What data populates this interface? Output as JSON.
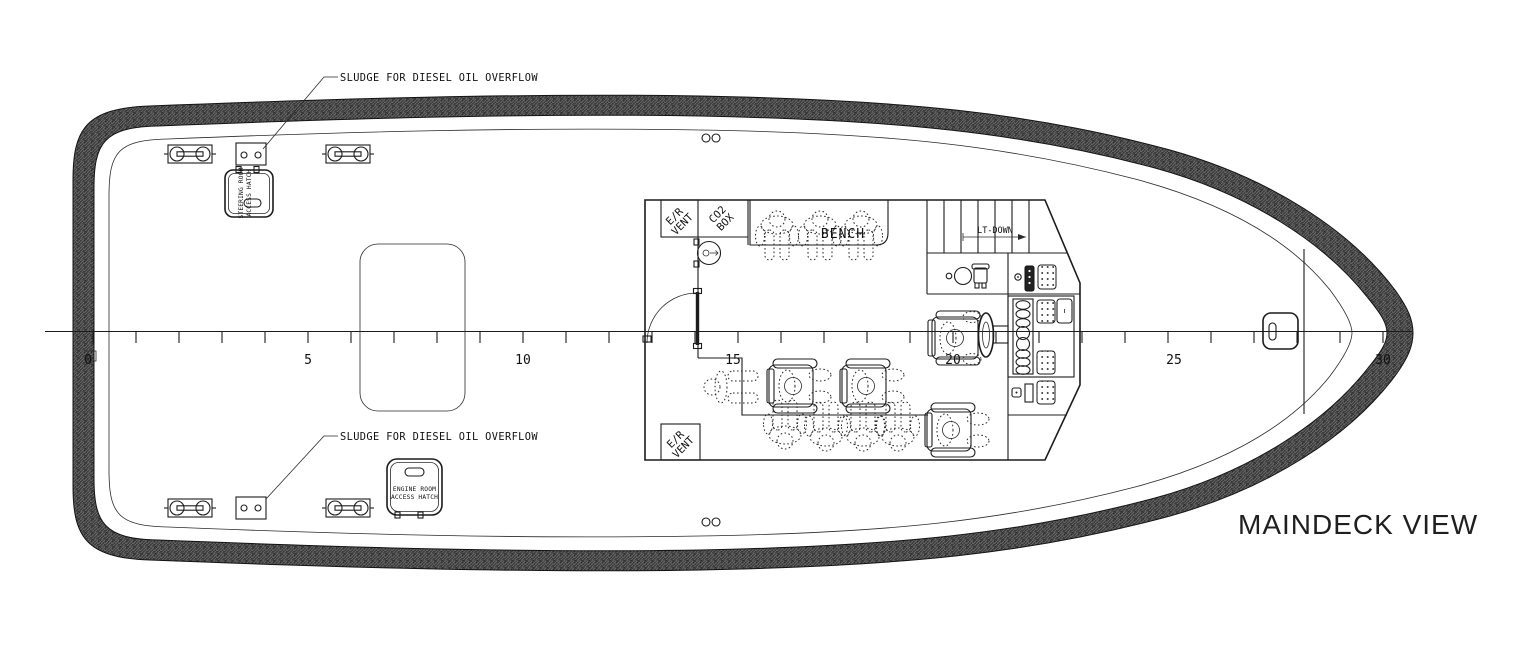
{
  "title": "MAINDECK VIEW",
  "drawing": {
    "labels": {
      "sludge_top": "SLUDGE FOR DIESEL OIL OVERFLOW",
      "sludge_bottom": "SLUDGE FOR DIESEL OIL OVERFLOW",
      "bench": "BENCH",
      "stair_direction": "LT-DOWN",
      "co2_line1": "CO2",
      "co2_line2": "BOX",
      "er_vent_line1": "E/R",
      "er_vent_line2": "VENT",
      "steering_hatch_line1": "STEERING ROOM",
      "steering_hatch_line2": "ACCESS HATCH",
      "engine_hatch_line1": "ENGINE ROOM",
      "engine_hatch_line2": "ACCESS HATCH"
    },
    "scale_ruler": {
      "unit_labels": [
        "0",
        "5",
        "10",
        "15",
        "20",
        "25",
        "30"
      ],
      "minor_tick_every_units": 1,
      "labeled_every_units": 5
    },
    "figures": {
      "bench_seated": 3,
      "forward_row_chairs": 2,
      "aft_bench_seated": 4,
      "side_chair": 1,
      "helm_chair": 1,
      "loose_figure": 1
    },
    "fittings": {
      "mooring_cleats": 4,
      "sludge_boxes": 2,
      "fairlead_pairs": 2,
      "access_hatches": 2,
      "er_vents": 2,
      "bow_hatch": 1
    },
    "colors": {
      "line": "#1c1c1c",
      "hull_band_fill": "#474747",
      "hull_band_hatch_dark": "#2d2d2d",
      "hull_band_hatch_light": "#6a6a6a",
      "background": "#ffffff"
    }
  }
}
